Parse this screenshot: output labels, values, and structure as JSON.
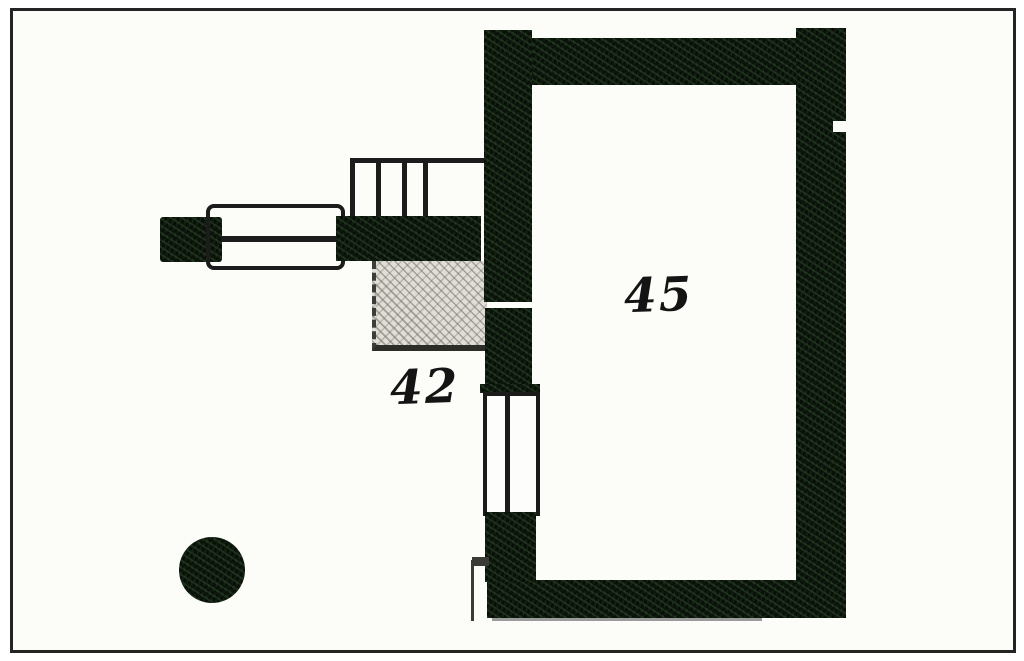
{
  "plan": {
    "rooms": [
      {
        "label": "42"
      },
      {
        "label": "45"
      }
    ],
    "colors": {
      "canvas_background": "#fcfcf9",
      "frame_border": "#242424",
      "wall_fill": "#0d160d",
      "wall_speckle_green": "#2c522a",
      "line_ink": "#1c1c1c",
      "hatch_fill": "#e0ded6",
      "hatch_line": "#8e8c86",
      "faint_shadow_line": "#9b9b9b"
    }
  }
}
